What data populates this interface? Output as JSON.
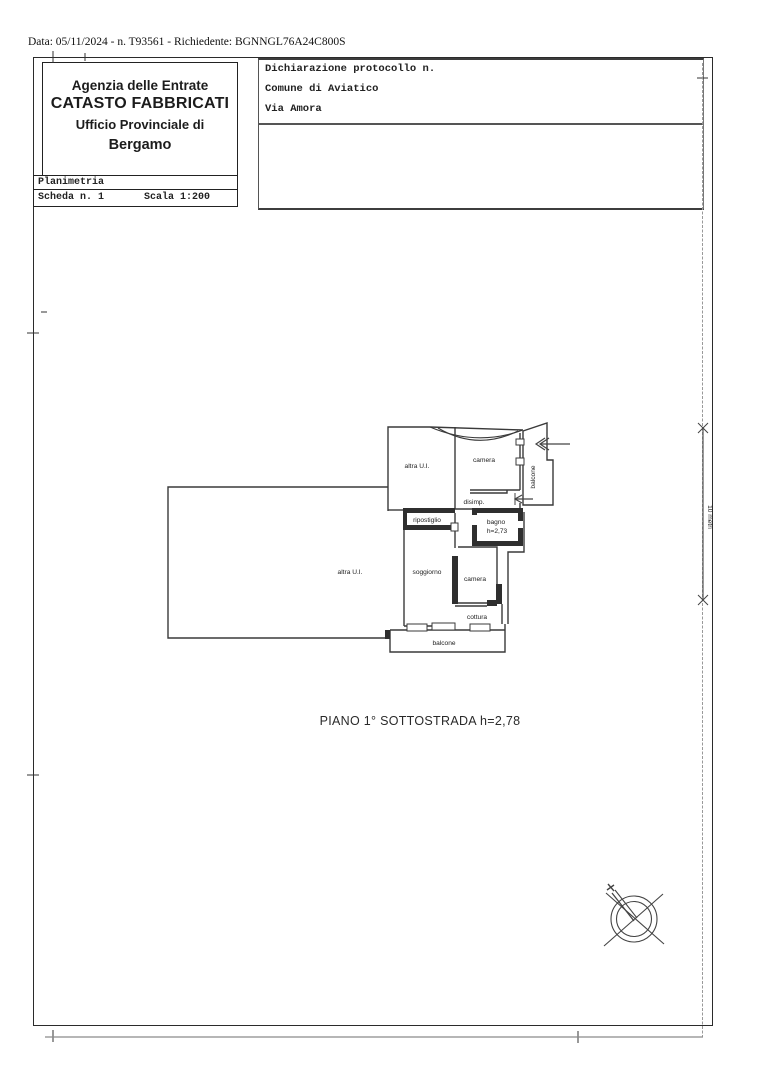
{
  "meta": {
    "top_line": "Data: 05/11/2024 - n. T93561 - Richiedente: BGNNGL76A24C800S"
  },
  "header": {
    "line1": "Agenzia delle Entrate",
    "line2": "CATASTO FABBRICATI",
    "line3": "Ufficio Provinciale di",
    "line4": "Bergamo"
  },
  "sheet_info": {
    "planimetria": "Planimetria",
    "scheda": "Scheda n. 1",
    "scala": "Scala 1:200"
  },
  "declaration": {
    "protocol": "Dichiarazione protocollo n.",
    "comune": "Comune di Aviatico",
    "via": "Via Amora"
  },
  "plan": {
    "title": "PIANO 1° SOTTOSTRADA h=2,78",
    "scale_label": "10 metri",
    "rooms": {
      "altra_ui_upper": "altra U.I.",
      "camera_upper": "camera",
      "balcone_right": "balcone",
      "disimp": "disimp.",
      "ripostiglio": "ripostiglio",
      "bagno_line1": "bagno",
      "bagno_line2": "h=2,73",
      "altra_ui_large": "altra U.I.",
      "soggiorno": "soggiorno",
      "camera_lower": "camera",
      "cottura": "cottura",
      "balcone_bottom": "balcone"
    }
  },
  "colors": {
    "ink": "#1c1c1c",
    "wall": "#3a3a3a",
    "faint": "#999999"
  }
}
